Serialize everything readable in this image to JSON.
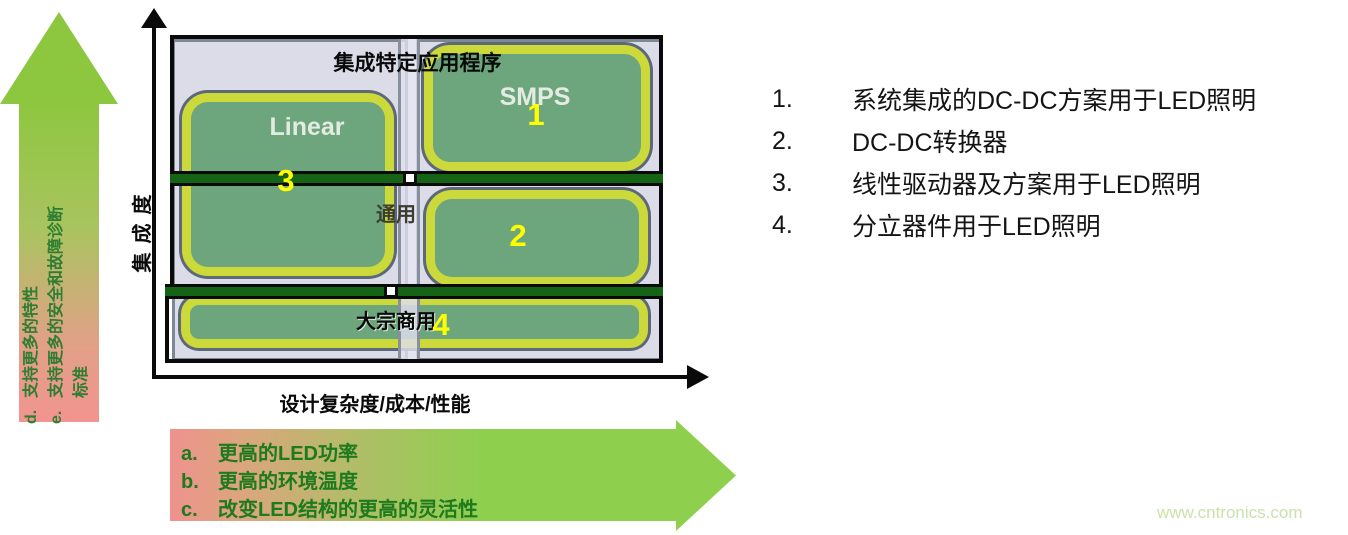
{
  "colors": {
    "arrow_green": "#8dc63f",
    "arrow_pink": "#ee928e",
    "box_green": "#6da57d",
    "box_ring_yellow": "#ccd93b",
    "divider_green": "#156315",
    "column_lavender": "#dcdce9",
    "number_yellow": "#ffff00",
    "arrow_text_green": "#1d7a1d"
  },
  "left_arrow": {
    "direction": "up",
    "items": [
      {
        "letter": "d.",
        "text": "支持更多的特性"
      },
      {
        "letter": "e.",
        "text": "支持更多的安全和故障诊断"
      },
      {
        "letter": "",
        "text": "标准"
      }
    ]
  },
  "chart": {
    "y_axis_label": "集成度",
    "x_axis_label": "设计复杂度/成本/性能",
    "row1_label": "集成特定应用程序",
    "row2_label": "通用",
    "row3_label": "大宗商用",
    "boxes": {
      "linear": {
        "label": "Linear",
        "number": "3"
      },
      "smps": {
        "label": "SMPS",
        "number": "1"
      },
      "box2": {
        "label": "",
        "number": "2"
      },
      "box4": {
        "label": "",
        "number": "4"
      }
    }
  },
  "legend": {
    "items": [
      {
        "num": "1.",
        "text": "系统集成的DC-DC方案用于LED照明"
      },
      {
        "num": "2.",
        "text": "DC-DC转换器"
      },
      {
        "num": "3.",
        "text": "线性驱动器及方案用于LED照明"
      },
      {
        "num": "4.",
        "text": "分立器件用于LED照明"
      }
    ]
  },
  "bottom_arrow": {
    "direction": "right",
    "items": [
      {
        "letter": "a.",
        "text": "更高的LED功率"
      },
      {
        "letter": "b.",
        "text": "更高的环境温度"
      },
      {
        "letter": "c.",
        "text": "改变LED结构的更高的灵活性"
      }
    ]
  },
  "watermark": "www.cntronics.com"
}
